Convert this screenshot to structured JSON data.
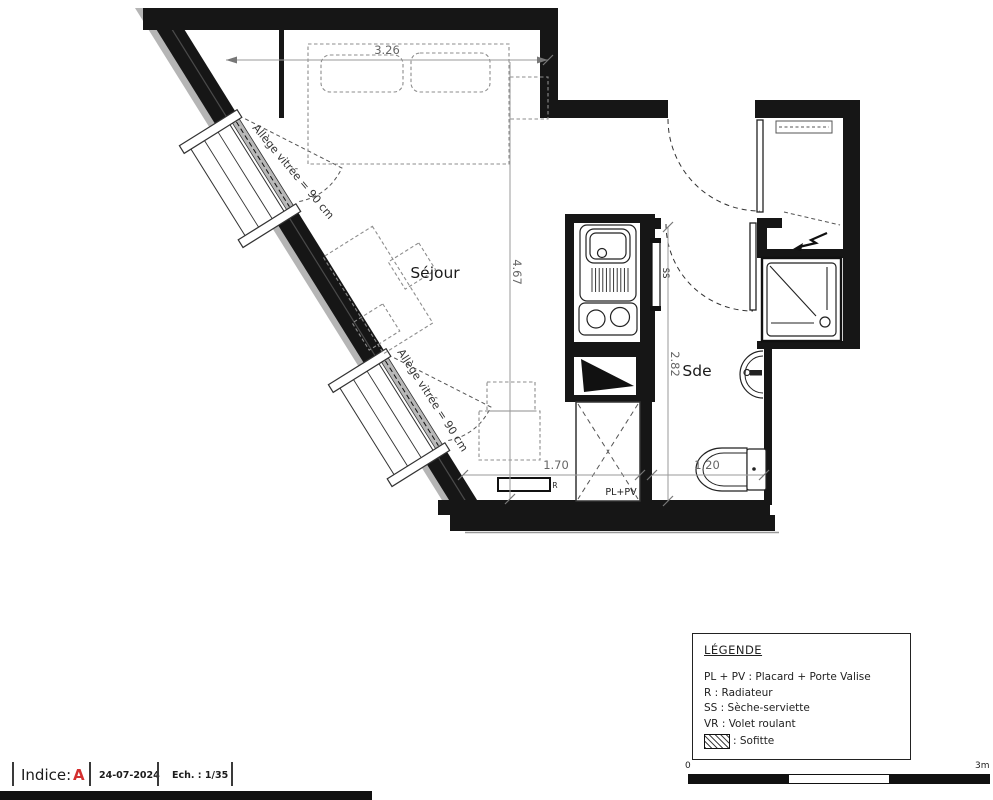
{
  "plan": {
    "rooms": {
      "sejour": "Séjour",
      "sde": "Sde"
    },
    "dimensions": {
      "top_width": "3.26",
      "living_height": "4.67",
      "sde_height": "2.82",
      "bottom_left": "1.70",
      "bottom_right": "1.20"
    },
    "windows": {
      "window1_label": "Allège vitrée = 90 cm",
      "window2_label": "Allège vitrée = 90 cm"
    },
    "annotations": {
      "closet": "PL+PV",
      "towel_radiator": "SS",
      "radiator": "R"
    }
  },
  "legend": {
    "title": "LÉGENDE",
    "entries": [
      "PL + PV : Placard + Porte Valise",
      "R : Radiateur",
      "SS : Sèche-serviette",
      "VR : Volet roulant"
    ],
    "sofitte_label": ": Sofitte"
  },
  "scalebar": {
    "start": "0",
    "end": "3m"
  },
  "titlebar": {
    "indice_label": "Indice:",
    "indice_value": "A",
    "date": "24-07-2024",
    "scale": "Ech. : 1/35"
  },
  "colors": {
    "wall": "#161616",
    "accent_red": "#d32f2f",
    "dim_gray": "#8a8a8a",
    "glazing": "#b8b8b8"
  }
}
